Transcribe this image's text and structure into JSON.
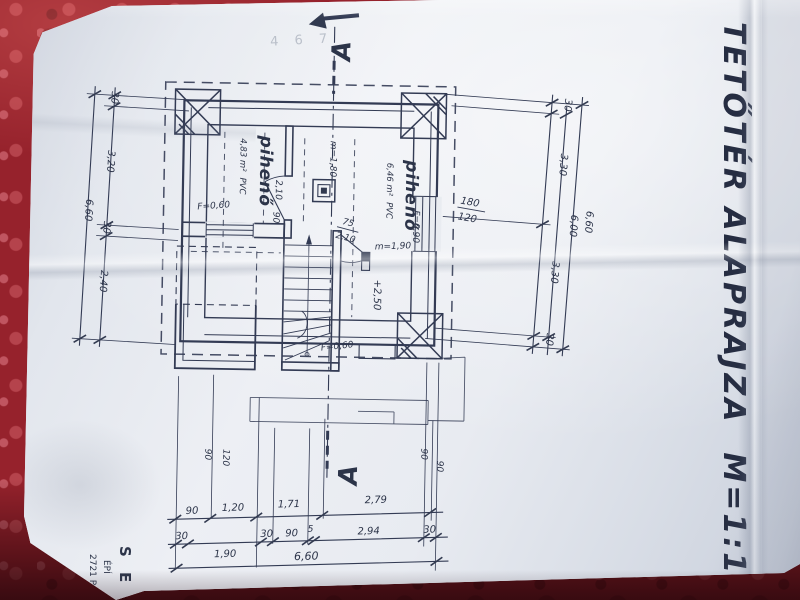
{
  "photo": {
    "paper_color": "#e6e9ef",
    "ink_color": "#323a50",
    "cloth_color": "#96222c"
  },
  "title": {
    "text": "TETŐTÉR ALAPRAJZA",
    "scale": "M=1:100"
  },
  "section": {
    "top_label": "A",
    "bottom_label": "A"
  },
  "rooms": [
    {
      "name": "pihenő",
      "area": "4,83 m²",
      "floor": "PVC"
    },
    {
      "name": "pihenő",
      "area": "6,46 m²",
      "floor": "PVC"
    }
  ],
  "annotations": {
    "headroom_line": "m=1,80",
    "headroom_mark": "m=1,90",
    "level_mark": "+2,50",
    "sill_left": "F=0,60",
    "sill_right": "F=0,90",
    "sill_stair": "F=0,60",
    "door_main_height": "2,10",
    "door_main_width": "90",
    "door_small_width": "75",
    "door_small_height": "2,10",
    "window_width": "180",
    "window_height": "120",
    "pencil_note": "4 6 7"
  },
  "dimensions": {
    "left": {
      "segments": [
        "30",
        "3,20",
        "30",
        "2,40"
      ],
      "total": "6,60"
    },
    "right": {
      "segments": [
        "30",
        "3,30",
        "3,30",
        "30"
      ],
      "clear": "6,00",
      "total": "6,60"
    },
    "bottom": {
      "row1": [
        "90",
        "1,20",
        "1,71",
        "2,79"
      ],
      "row2": [
        "30",
        "1,90",
        "30",
        "90",
        "5",
        "2,94",
        "30"
      ],
      "total": "6,60",
      "stub_left": [
        "90",
        "120"
      ],
      "stub_right": [
        "90",
        "90"
      ]
    }
  },
  "stamp": {
    "line1": "S E D",
    "line2": "ÉPÍ",
    "line3": "2721 P"
  }
}
